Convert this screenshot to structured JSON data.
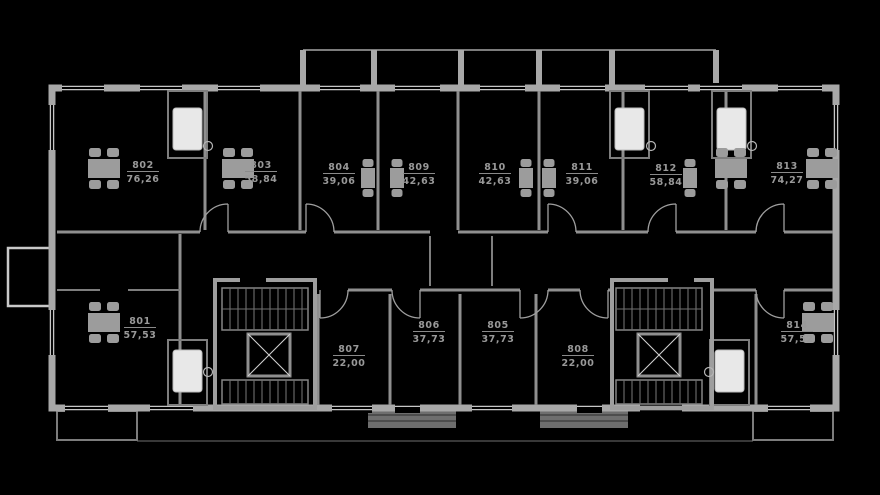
{
  "plan": {
    "type": "residential-floor-plan",
    "units": [
      {
        "id": "801",
        "area": "57,53"
      },
      {
        "id": "802",
        "area": "76,26"
      },
      {
        "id": "803",
        "area": "58,84"
      },
      {
        "id": "804",
        "area": "39,06"
      },
      {
        "id": "805",
        "area": "37,73"
      },
      {
        "id": "806",
        "area": "37,73"
      },
      {
        "id": "807",
        "area": "22,00"
      },
      {
        "id": "808",
        "area": "22,00"
      },
      {
        "id": "809",
        "area": "42,63"
      },
      {
        "id": "810",
        "area": "42,63"
      },
      {
        "id": "811",
        "area": "39,06"
      },
      {
        "id": "812",
        "area": "58,84"
      },
      {
        "id": "813",
        "area": "74,27"
      },
      {
        "id": "814",
        "area": "57,52"
      }
    ]
  },
  "colors": {
    "background": "#000000",
    "wall_primary": "#a8a8a8",
    "wall_secondary": "#8f8f8f",
    "detail": "#6f6f6f",
    "window": "#c6c6c6",
    "fixture_white": "#e8e8e8",
    "label_text": "#999999"
  }
}
